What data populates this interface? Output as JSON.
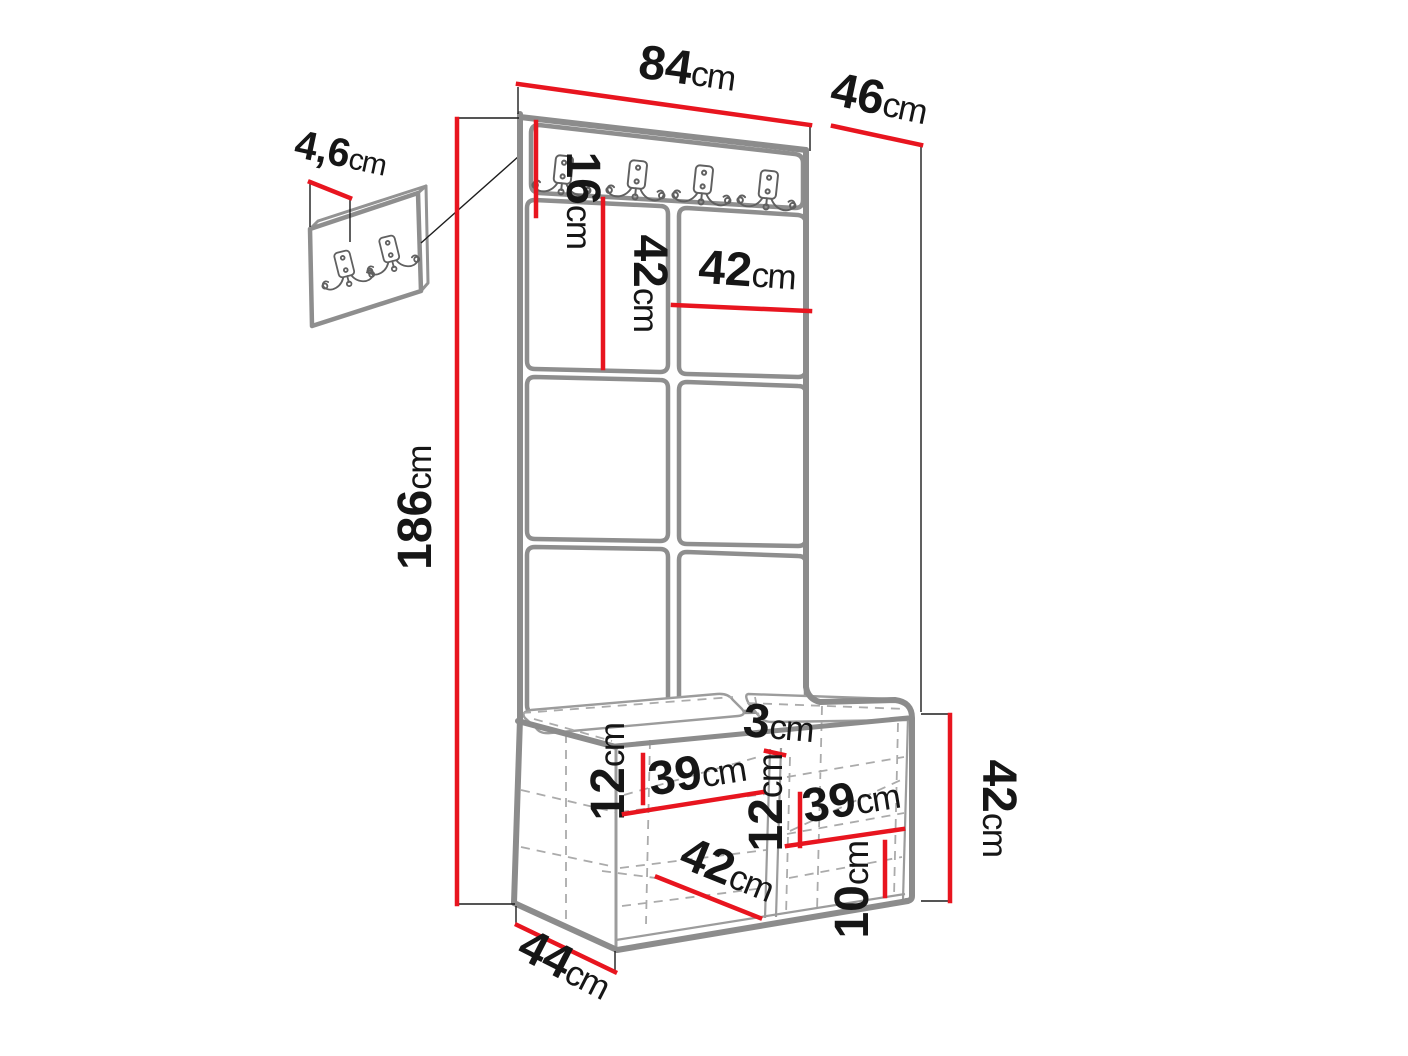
{
  "diagram_title": "hallway-unit-dimension-diagram",
  "colors": {
    "dimension_red": "#e8151f",
    "outline_gray": "#8c8c8c",
    "hidden_edge_gray": "#ababab",
    "text_black": "#161616",
    "background": "#ffffff"
  },
  "dimensions": {
    "width_top": {
      "value": "84",
      "unit": "cm"
    },
    "depth_top": {
      "value": "46",
      "unit": "cm"
    },
    "hook_panel_height": {
      "value": "16",
      "unit": "cm"
    },
    "wall_panel_thickness": {
      "value": "4,6",
      "unit": "cm"
    },
    "panel_tile_height": {
      "value": "42",
      "unit": "cm"
    },
    "panel_tile_width": {
      "value": "42",
      "unit": "cm"
    },
    "total_height": {
      "value": "186",
      "unit": "cm"
    },
    "bench_compartment_height_left": {
      "value": "12",
      "unit": "cm"
    },
    "bench_compartment_width_left": {
      "value": "39",
      "unit": "cm"
    },
    "center_gap": {
      "value": "3",
      "unit": "cm"
    },
    "bench_compartment_height_right": {
      "value": "12",
      "unit": "cm"
    },
    "bench_compartment_width_right": {
      "value": "39",
      "unit": "cm"
    },
    "bench_inner_width": {
      "value": "42",
      "unit": "cm"
    },
    "shelf_height": {
      "value": "10",
      "unit": "cm"
    },
    "bench_height": {
      "value": "42",
      "unit": "cm"
    },
    "bench_depth": {
      "value": "44",
      "unit": "cm"
    }
  }
}
